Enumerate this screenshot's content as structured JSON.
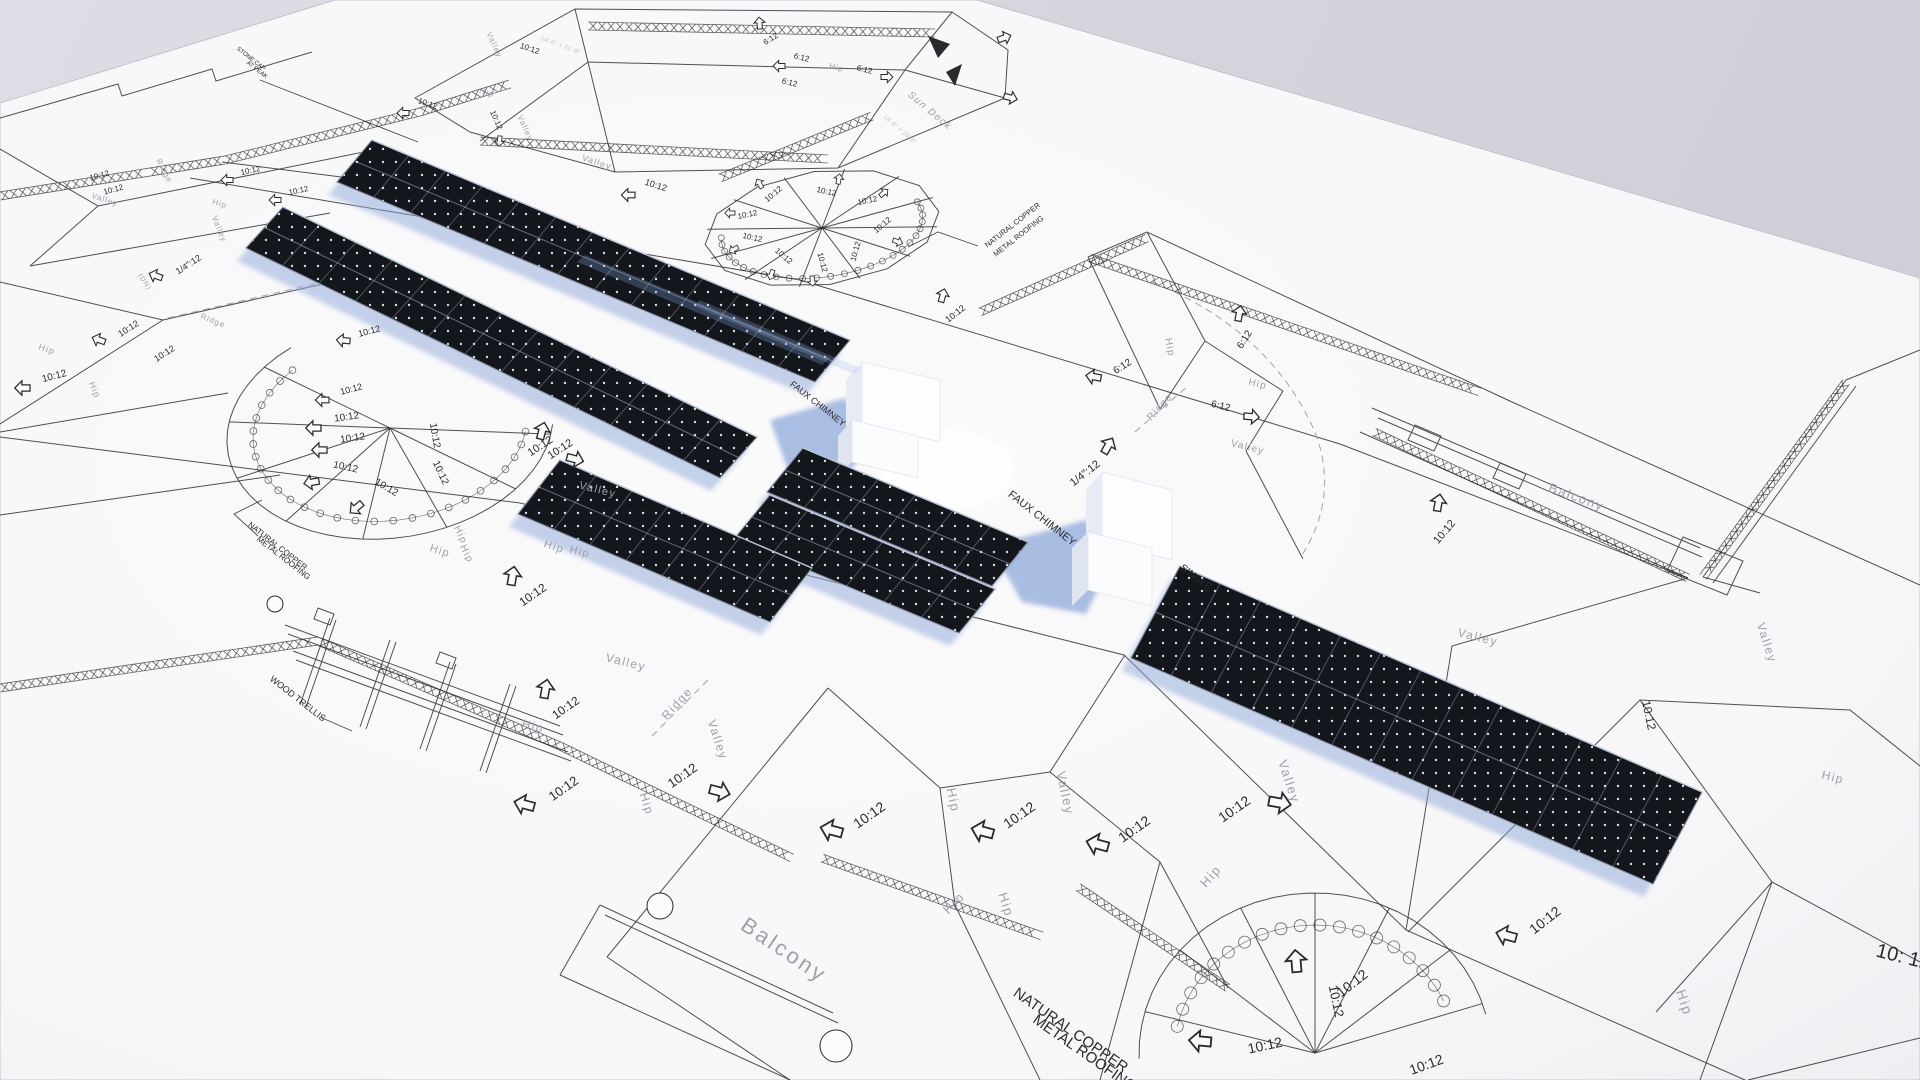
{
  "colors": {
    "background_top": "#dedde5",
    "background_bottom": "#cdccd7",
    "paper": "#f8f7f8",
    "ink": "#2a2a2e",
    "muted_label": "#9fa0a8",
    "panel_dark": "#13161b",
    "panel_dot": "#dfe6f2",
    "shadow_blue": "#8fa9da"
  },
  "drawing": {
    "labels": [
      [
        "10:12",
        100,
        178,
        -15,
        8,
        "b"
      ],
      [
        "10:12",
        114,
        192,
        -15,
        8,
        "b"
      ],
      [
        "10:12",
        251,
        173,
        -12,
        8,
        "b"
      ],
      [
        "10:12",
        299,
        193,
        -12,
        8,
        "b"
      ],
      [
        "Valley",
        104,
        202,
        18,
        8,
        "g"
      ],
      [
        "Ridge",
        162,
        172,
        62,
        8,
        "g"
      ],
      [
        "Hip",
        219,
        206,
        18,
        8,
        "g"
      ],
      [
        "Valley",
        217,
        230,
        68,
        8,
        "g"
      ],
      [
        "1/4\":12",
        190,
        267,
        -33,
        9,
        "b"
      ],
      [
        "(DN)",
        143,
        283,
        55,
        7,
        "g"
      ],
      [
        "10:12",
        130,
        331,
        -33,
        9,
        "b"
      ],
      [
        "10:12",
        166,
        356,
        -33,
        9,
        "b"
      ],
      [
        "Hip",
        46,
        352,
        18,
        9,
        "g"
      ],
      [
        "10:12",
        55,
        379,
        -15,
        10,
        "b"
      ],
      [
        "Hip",
        92,
        391,
        68,
        9,
        "g"
      ],
      [
        "Ridge",
        212,
        323,
        22,
        8,
        "g"
      ],
      [
        "STONE CAP",
        250,
        60,
        38,
        6,
        "b"
      ],
      [
        "AT PEAK",
        256,
        71,
        38,
        6,
        "b"
      ],
      [
        "10:12",
        427,
        106,
        18,
        8,
        "b"
      ],
      [
        "10:12",
        494,
        121,
        66,
        8,
        "b"
      ],
      [
        "Hip",
        486,
        95,
        18,
        8,
        "g"
      ],
      [
        "Valley",
        523,
        129,
        66,
        8,
        "g"
      ],
      [
        "Valley",
        492,
        46,
        66,
        8,
        "g"
      ],
      [
        "10:12",
        529,
        51,
        18,
        8,
        "b"
      ],
      [
        "14'-6\" × 21'-8\"",
        560,
        47,
        20,
        6,
        "f"
      ],
      [
        "Valley",
        596,
        165,
        18,
        9,
        "g"
      ],
      [
        "10:12",
        655,
        188,
        18,
        9,
        "b"
      ],
      [
        "10:12",
        775,
        196,
        -40,
        8,
        "b"
      ],
      [
        "10:12",
        748,
        217,
        -12,
        8,
        "b"
      ],
      [
        "10:12",
        752,
        240,
        12,
        8,
        "b"
      ],
      [
        "10:12",
        782,
        258,
        40,
        8,
        "b"
      ],
      [
        "10:12",
        820,
        263,
        75,
        8,
        "b"
      ],
      [
        "10:12",
        858,
        252,
        -75,
        8,
        "b"
      ],
      [
        "10:12",
        884,
        227,
        -40,
        8,
        "b"
      ],
      [
        "10:12",
        868,
        203,
        -12,
        8,
        "b"
      ],
      [
        "10:12",
        826,
        194,
        12,
        8,
        "b"
      ],
      [
        "6:12",
        772,
        41,
        -32,
        8,
        "b"
      ],
      [
        "6:12",
        801,
        60,
        14,
        8,
        "b"
      ],
      [
        "6:12",
        789,
        85,
        14,
        8,
        "b"
      ],
      [
        "Hip",
        836,
        70,
        14,
        8,
        "g"
      ],
      [
        "6:12",
        864,
        72,
        14,
        8,
        "b"
      ],
      [
        "Sun Deck",
        928,
        113,
        40,
        10,
        "g"
      ],
      [
        "14'-6\" × 25'-8\"",
        899,
        131,
        40,
        6,
        "f"
      ],
      [
        "NATURAL COPPER",
        1014,
        227,
        -38,
        7.5,
        "b"
      ],
      [
        "METAL ROOFING",
        1020,
        238,
        -38,
        7.5,
        "b"
      ],
      [
        "10:12",
        957,
        316,
        -38,
        9,
        "b"
      ],
      [
        "6:12",
        1124,
        369,
        -33,
        10,
        "b"
      ],
      [
        "6:12",
        1247,
        341,
        -58,
        10,
        "b"
      ],
      [
        "6:12",
        1220,
        409,
        14,
        10,
        "b"
      ],
      [
        "Hip",
        1167,
        348,
        78,
        10,
        "g"
      ],
      [
        "Hip",
        1257,
        387,
        14,
        10,
        "g"
      ],
      [
        "Ridge",
        1162,
        409,
        -48,
        10,
        "g"
      ],
      [
        "Valley",
        1247,
        450,
        14,
        10,
        "g"
      ],
      [
        "Balcony",
        1575,
        501,
        20,
        13,
        "g"
      ],
      [
        "10:12",
        1447,
        534,
        -50,
        11,
        "b"
      ],
      [
        "Valley",
        1477,
        641,
        14,
        12,
        "g"
      ],
      [
        "Valley",
        1763,
        644,
        72,
        12,
        "g"
      ],
      [
        "10:12",
        1645,
        716,
        78,
        12,
        "b"
      ],
      [
        "Hip",
        1832,
        781,
        14,
        12,
        "g"
      ],
      [
        "10: 12",
        1902,
        963,
        14,
        20,
        "b"
      ],
      [
        "Hip",
        1680,
        1004,
        72,
        14,
        "g"
      ],
      [
        "10:12",
        1548,
        924,
        -38,
        14,
        "b"
      ],
      [
        "FAUX CHIMNEY",
        816,
        406,
        38,
        9,
        "b"
      ],
      [
        "FAUX CHIMNEY",
        1040,
        521,
        38,
        11,
        "b"
      ],
      [
        "1/4\":12",
        1087,
        476,
        -38,
        11,
        "b"
      ],
      [
        "SINGLE",
        1194,
        580,
        38,
        10,
        "b"
      ],
      [
        "10:12",
        562,
        452,
        -33,
        11,
        "b"
      ],
      [
        "Valley",
        597,
        493,
        14,
        11,
        "g"
      ],
      [
        "Hip",
        579,
        555,
        14,
        11,
        "g"
      ],
      [
        "NATURAL COPPER",
        276,
        548,
        38,
        8,
        "b"
      ],
      [
        "METAL ROOFING",
        282,
        560,
        38,
        8,
        "b"
      ],
      [
        "10:12",
        370,
        334,
        -15,
        9,
        "b"
      ],
      [
        "10:12",
        542,
        449,
        -33,
        11,
        "b"
      ],
      [
        "Hip",
        458,
        536,
        64,
        10,
        "g"
      ],
      [
        "Hip",
        464,
        555,
        64,
        10,
        "g"
      ],
      [
        "WOOD TRELLIS",
        296,
        701,
        38,
        9,
        "b"
      ],
      [
        "Hip",
        439,
        554,
        18,
        11,
        "g"
      ],
      [
        "Hip",
        553,
        550,
        18,
        11,
        "g"
      ],
      [
        "10:12",
        535,
        598,
        -35,
        12,
        "b"
      ],
      [
        "Valley",
        625,
        666,
        14,
        12,
        "g"
      ],
      [
        "10:12",
        568,
        711,
        -35,
        12,
        "b"
      ],
      [
        "Hip",
        532,
        730,
        14,
        12,
        "g"
      ],
      [
        "Ridge",
        680,
        706,
        -48,
        12,
        "g"
      ],
      [
        "Valley",
        714,
        741,
        72,
        12,
        "g"
      ],
      [
        "10:12",
        566,
        792,
        -35,
        13,
        "b"
      ],
      [
        "10:12",
        685,
        779,
        -35,
        13,
        "b"
      ],
      [
        "Hip",
        643,
        805,
        72,
        12,
        "g"
      ],
      [
        "Balcony",
        780,
        956,
        34,
        22,
        "g"
      ],
      [
        "10:12",
        872,
        819,
        -35,
        14,
        "b"
      ],
      [
        "Hip",
        949,
        801,
        78,
        13,
        "g"
      ],
      [
        "10:12",
        1022,
        819,
        -35,
        14,
        "b"
      ],
      [
        "Valley",
        1061,
        794,
        78,
        13,
        "g"
      ],
      [
        "Hip",
        957,
        906,
        -45,
        13,
        "g"
      ],
      [
        "Hip",
        1002,
        906,
        72,
        13,
        "g"
      ],
      [
        "10:12",
        1137,
        833,
        -35,
        14,
        "b"
      ],
      [
        "Hip",
        1214,
        879,
        -48,
        13,
        "g"
      ],
      [
        "10:12",
        1237,
        813,
        -35,
        14,
        "b"
      ],
      [
        "Valley",
        1285,
        783,
        72,
        13,
        "g"
      ],
      [
        "NATURAL COPPER",
        1068,
        1034,
        35,
        15,
        "b"
      ],
      [
        "METAL ROOFING",
        1082,
        1057,
        35,
        15,
        "b"
      ],
      [
        "10:12",
        1355,
        987,
        -38,
        14,
        "b"
      ],
      [
        "10:12",
        1266,
        1050,
        -12,
        14,
        "b"
      ],
      [
        "10:12",
        1428,
        1069,
        -20,
        14,
        "b"
      ],
      [
        "10:12",
        1332,
        1002,
        78,
        13,
        "b"
      ],
      [
        "10:12",
        352,
        392,
        -15,
        9,
        "b"
      ],
      [
        "10:12",
        347,
        420,
        -8,
        10,
        "b"
      ],
      [
        "10:12",
        353,
        441,
        -8,
        10,
        "b"
      ],
      [
        "10:12",
        345,
        470,
        12,
        10,
        "b"
      ],
      [
        "10:12",
        385,
        490,
        30,
        10,
        "b"
      ],
      [
        "10:12",
        432,
        436,
        80,
        10,
        "b"
      ],
      [
        "10:12",
        438,
        474,
        65,
        10,
        "b"
      ]
    ],
    "arrows": [
      [
        233,
        180,
        180,
        7
      ],
      [
        281,
        200,
        180,
        7
      ],
      [
        162,
        278,
        200,
        8
      ],
      [
        105,
        342,
        200,
        8
      ],
      [
        30,
        388,
        180,
        9
      ],
      [
        409,
        113,
        180,
        7
      ],
      [
        500,
        136,
        95,
        6
      ],
      [
        635,
        195,
        180,
        8
      ],
      [
        762,
        188,
        -120,
        6
      ],
      [
        735,
        213,
        180,
        6
      ],
      [
        738,
        247,
        150,
        6
      ],
      [
        773,
        270,
        110,
        6
      ],
      [
        812,
        276,
        85,
        6
      ],
      [
        893,
        240,
        20,
        6
      ],
      [
        880,
        196,
        -40,
        6
      ],
      [
        838,
        184,
        -80,
        6
      ],
      [
        760,
        29,
        -95,
        7
      ],
      [
        785,
        66,
        180,
        7
      ],
      [
        881,
        77,
        0,
        7
      ],
      [
        941,
        302,
        -75,
        8
      ],
      [
        1101,
        378,
        190,
        9
      ],
      [
        1238,
        321,
        -80,
        9
      ],
      [
        1244,
        416,
        5,
        9
      ],
      [
        1437,
        511,
        -80,
        10
      ],
      [
        1516,
        938,
        195,
        12
      ],
      [
        1104,
        453,
        -60,
        10
      ],
      [
        540,
        439,
        -75,
        10
      ],
      [
        350,
        341,
        185,
        8
      ],
      [
        567,
        457,
        15,
        10
      ],
      [
        511,
        585,
        -80,
        11
      ],
      [
        544,
        698,
        -80,
        11
      ],
      [
        534,
        807,
        195,
        12
      ],
      [
        710,
        789,
        15,
        12
      ],
      [
        842,
        833,
        195,
        13
      ],
      [
        993,
        834,
        195,
        13
      ],
      [
        1108,
        847,
        195,
        13
      ],
      [
        1269,
        801,
        10,
        13
      ],
      [
        1297,
        972,
        -95,
        13
      ],
      [
        1211,
        1042,
        185,
        13
      ],
      [
        329,
        400,
        180,
        8
      ],
      [
        321,
        428,
        180,
        9
      ],
      [
        327,
        450,
        180,
        9
      ],
      [
        319,
        481,
        170,
        9
      ],
      [
        362,
        503,
        140,
        9
      ],
      [
        998,
        40,
        -20,
        8
      ],
      [
        1004,
        96,
        15,
        8
      ]
    ],
    "leaders": [
      "260,80 418,142",
      "978,246 938,232 908,247",
      "851,424 886,431 898,443",
      "1079,541 1110,550 1122,566",
      "1207,594 1186,612",
      "258,536 234,514 262,500",
      "320,717 352,731"
    ],
    "chains": [
      [
        [
          0,
          196
        ],
        [
          150,
          172
        ],
        [
          225,
          160
        ]
      ],
      [
        [
          225,
          160
        ],
        [
          420,
          112
        ],
        [
          510,
          84
        ]
      ],
      [
        [
          588,
          26
        ],
        [
          935,
          33
        ]
      ],
      [
        [
          480,
          141
        ],
        [
          828,
          159
        ]
      ],
      [
        [
          720,
          178
        ],
        [
          872,
          116
        ]
      ],
      [
        [
          1090,
          258
        ],
        [
          1480,
          392
        ]
      ],
      [
        [
          980,
          312
        ],
        [
          1147,
          238
        ]
      ],
      [
        [
          0,
          688
        ],
        [
          318,
          641
        ]
      ],
      [
        [
          320,
          642
        ],
        [
          560,
          746
        ],
        [
          792,
          858
        ]
      ],
      [
        [
          822,
          858
        ],
        [
          1042,
          936
        ]
      ],
      [
        [
          1078,
          887
        ],
        [
          1228,
          988
        ]
      ],
      [
        [
          1846,
          382
        ],
        [
          1703,
          577
        ]
      ],
      [
        [
          1374,
          432
        ],
        [
          1688,
          578
        ]
      ]
    ],
    "arrays": [
      {
        "q": [
          [
            372,
            140
          ],
          [
            850,
            340
          ],
          [
            815,
            382
          ],
          [
            337,
            182
          ]
        ],
        "cols": 13
      },
      {
        "q": [
          [
            283,
            207
          ],
          [
            757,
            437
          ],
          [
            720,
            478
          ],
          [
            246,
            248
          ]
        ],
        "cols": 13
      },
      {
        "q": [
          [
            803,
            448
          ],
          [
            1028,
            542
          ],
          [
            992,
            586
          ],
          [
            767,
            492
          ]
        ],
        "cols": 6
      },
      {
        "q": [
          [
            770,
            495
          ],
          [
            995,
            589
          ],
          [
            959,
            633
          ],
          [
            734,
            539
          ]
        ],
        "cols": 6
      },
      {
        "q": [
          [
            560,
            460
          ],
          [
            812,
            568
          ],
          [
            770,
            622
          ],
          [
            518,
            514
          ]
        ],
        "cols": 7
      },
      {
        "q": [
          [
            1180,
            566
          ],
          [
            1702,
            792
          ],
          [
            1653,
            884
          ],
          [
            1131,
            658
          ]
        ],
        "cols": 13
      }
    ],
    "turrets": [
      {
        "cx": 822,
        "cy": 228,
        "rx": 118,
        "ry": 57,
        "rot": -8,
        "poly": 30,
        "arc": [
          0,
          360
        ],
        "spokes": [
          15,
          45,
          75,
          105,
          135,
          165,
          195,
          225,
          255,
          285,
          315,
          345
        ],
        "ring": {
          "k": 0.86,
          "a0": -15,
          "a1": 185,
          "r": 3
        }
      },
      {
        "cx": 390,
        "cy": 428,
        "rx": 164,
        "ry": 110,
        "rot": -8,
        "arc": [
          10,
          240
        ],
        "spokes": [
          15,
          45,
          75,
          105,
          135,
          165,
          195,
          225
        ],
        "ring": {
          "k": 0.84,
          "a0": 14,
          "a1": 235,
          "r": 3.4
        }
      },
      {
        "cx": 1315,
        "cy": 1053,
        "rx": 176,
        "ry": 160,
        "rot": 0,
        "arc": [
          -182,
          -14
        ],
        "spokes": [
          -165,
          -140,
          -115,
          -90,
          -65,
          -40,
          -18
        ],
        "ring": {
          "k": 0.8,
          "a0": -168,
          "a1": -22,
          "r": 6
        }
      }
    ]
  }
}
